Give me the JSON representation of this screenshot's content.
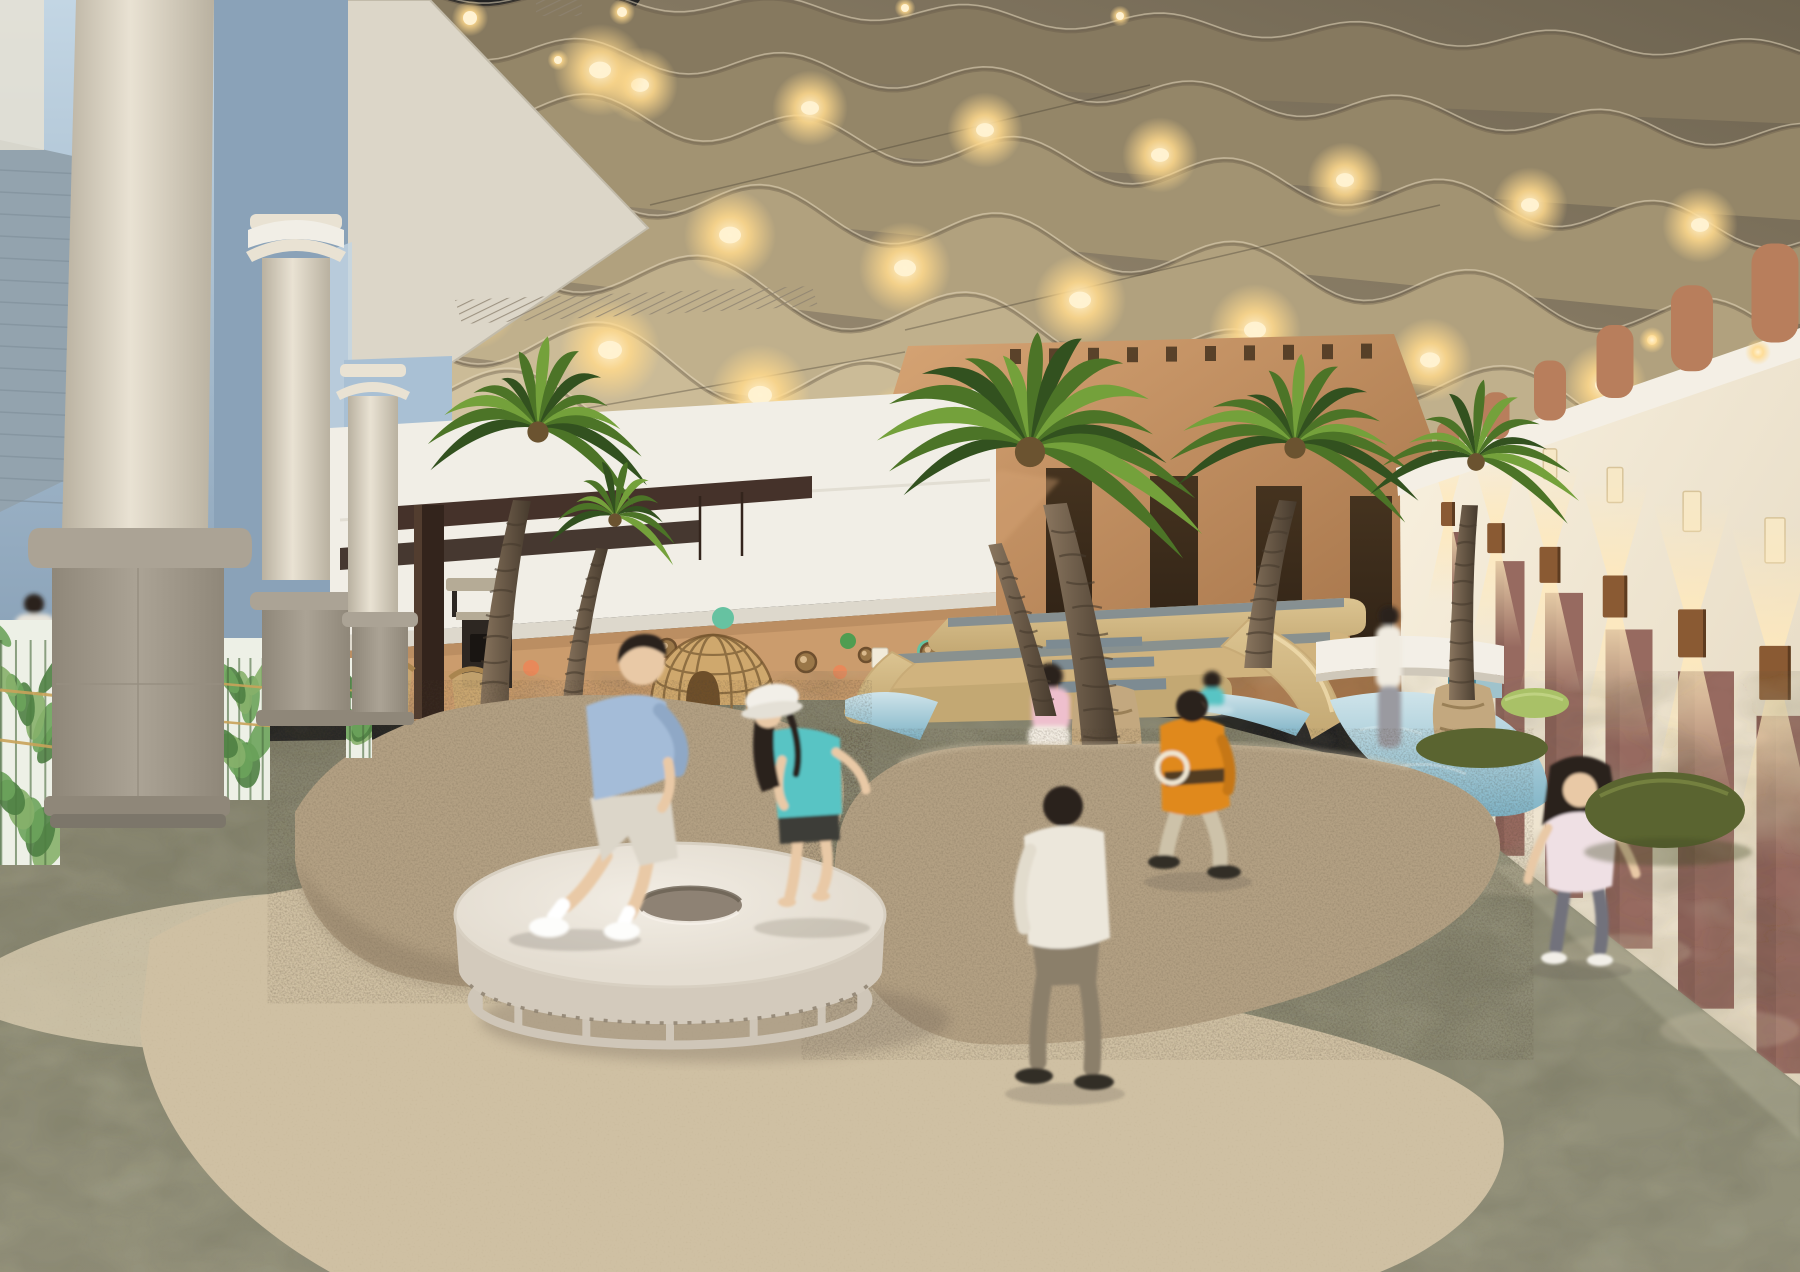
{
  "meta": {
    "kind": "architectural-rendering",
    "description": "Photorealistic rendering of an indoor children's beach-themed playground: wavy acoustic ceiling with warm downlights, classical colonnade with glass plant-mural balustrade on the left, indoor palm trees, carpeted sand dunes, a round white trampoline with a hole, a rattan dome hut, a tiered wooden play structure with slides into a shallow pool, an adobe-style tan building, and a lantern-lit corridor of mauve doors on the right. Children play throughout."
  },
  "palette": {
    "ceilingDark": "#6d6350",
    "ceilingMid": "#a4957a",
    "wave1": "#86795f",
    "wave2": "#948668",
    "wave3": "#a29372",
    "wave4": "#b1a17e",
    "wave5": "#c0b08c",
    "wave6": "#cbbb97",
    "wave7": "#d2c3a1",
    "waveEdge": "#665a48",
    "waveHi": "#e5d9bd",
    "soffit": "#dcd6c8",
    "soffitShade": "#c2bbaa",
    "grille": "#8d8270",
    "glow": "#ffd98c",
    "glowCore": "#fff2d2",
    "coneLight": "#ffe9bc",
    "glassLight": "#c3d6e4",
    "glass": "#a9c0d4",
    "glassDeep": "#8aa2b8",
    "brick": "#93a3ae",
    "whiteWall": "#f1eee6",
    "whiteWallShade": "#ddd8cc",
    "tanWall": "#cb9c6d",
    "tanShade": "#b1855c",
    "adobeLit": "#d6a474",
    "adobe": "#c08a5c",
    "adobeShade": "#a06f45",
    "doorDark": "#45331f",
    "doorDark2": "#2e2115",
    "rightWall": "#f3ebd9",
    "rightWallLit": "#f9f1df",
    "rightWallShade": "#e2d6bf",
    "fascia": "#f4efe5",
    "mauve": "#976a60",
    "mauveDark": "#7d564e",
    "sconce": "#8a5a33",
    "stub": "#b87e5c",
    "nicheGlow": "#f7e8c6",
    "pergola": "#45322a",
    "pergolaDeep": "#33241c",
    "kioskDark": "#2d2722",
    "stone": "#b5ab96",
    "wicker": "#c8a671",
    "woodTable": "#b98a5a",
    "domeFill": "#cfa86d",
    "domeLine": "#8f6f42",
    "domeDark": "#6e4f2a",
    "wood": "#dcc491",
    "woodMid": "#d0b37e",
    "woodShade": "#c3a873",
    "tread": "#7d8b92",
    "pool": "#7fb3c6",
    "poolLight": "#cfe4ea",
    "aqua": "#4f8fa0",
    "aquaLight": "#9fc3cc",
    "mound": "#b3a083",
    "moundDark": "#4a3d2e",
    "floorA": "#84826d",
    "floorB": "#94927b",
    "floorDark": "#55543f",
    "floorLight": "#b9b79e",
    "sand": "#cfc0a3",
    "sandLight": "#d9ccb0",
    "sandGrain": "#8a7a5e",
    "tramp": "#e4ddd1",
    "trampTop": "#f2ede4",
    "trampShade": "#d3cabc",
    "trampBase": "#cfc6b8",
    "trampHole": "#8e8274",
    "poufGreen": "#a9c167",
    "poufOlive": "#5a6430",
    "trunk": "#6b5948",
    "trunkDark": "#463a2d",
    "trunkLight": "#8a765f",
    "burlap": "#c3a87f",
    "frondDark": "#32511f",
    "frond": "#4c7427",
    "frondLight": "#74a13b",
    "tuft": "#6b5330",
    "columnLight": "#e9e2d3",
    "columnShade": "#b9b1a0",
    "pedestal": "#aba395",
    "pedestalDark": "#8f8779",
    "muralBg": "#edf0e6",
    "leafA": "#6ca35b",
    "leafB": "#4e8042",
    "leafC": "#86b06a",
    "rail": "#c9a35a",
    "skin": "#e9c9a6",
    "hair": "#29221b",
    "blueShirt": "#a4bcd8",
    "blueShirtDark": "#8fa8c6",
    "whiteCloth": "#ece7db",
    "teal": "#58c4c4",
    "darkShorts": "#3c3c38",
    "khaki": "#cdc2a9",
    "orange": "#e0891c",
    "pantsGray": "#72727c",
    "pinkTop": "#efe0e4",
    "pinkSit": "#eebfcd",
    "pantsBrown": "#8b7f6b",
    "shoeDark": "#332d26",
    "white": "#f6f3ec"
  },
  "scene": {
    "ceiling": {
      "style": "undulating wavy acoustic ribbons",
      "lights": "warm recessed downlights at wave crests",
      "cables": 3
    },
    "left_colonnade": {
      "columns": 3,
      "pedestals": 3,
      "balustrade": "glass panels printed with tropical plants and two gold rails",
      "exterior": "blue-grey glazing and brick wall"
    },
    "cafe": {
      "pergola": "dark wood beam and post",
      "kiosk": "dark counter with black coffee machine",
      "chairs": "rattan armchairs",
      "seated_people": 2
    },
    "back_wall": {
      "upper": "white",
      "lower": "tan cork with round pegs",
      "dots_colors": [
        "mint",
        "green",
        "orange"
      ],
      "dome": "rattan lattice dome hut with arched opening"
    },
    "adobe_building": {
      "color": "terracotta tan",
      "parapet_slits": 10,
      "dark_doorways": 4
    },
    "play_structure": {
      "material": "bent plywood",
      "treads": "blue-grey",
      "slides": 2,
      "pool": "shallow light-blue water",
      "water_cubes": 2
    },
    "right_corridor": {
      "wall": "cream",
      "door_panels": 6,
      "sconces": "bronze cylinders with up/down light",
      "niches": "small lit wall niches",
      "beam_stubs": "terracotta cylinders above white fascia",
      "poufs": 3
    },
    "sand_area": {
      "mounds": 2,
      "texture": "speckled carpet dune",
      "trampoline": "round white membrane with central hole on ring base"
    },
    "palms": {
      "count": 5,
      "bases": "burlap/rope wrapped"
    },
    "children": [
      {
        "name": "boy-jumping",
        "outfit": "light blue shirt, white shorts, white socks"
      },
      {
        "name": "girl-trampoline",
        "outfit": "white bucket hat, teal top, dark shorts, barefoot"
      },
      {
        "name": "boy-walking-back",
        "outfit": "cream long-sleeve, brown trousers"
      },
      {
        "name": "boy-orange",
        "outfit": "orange jacket with ring pack, khaki trousers"
      },
      {
        "name": "girl-running",
        "outfit": "pink-white top, grey trousers"
      },
      {
        "name": "girl-sitting-platform",
        "outfit": "pink top, white skirt"
      },
      {
        "name": "child-in-water",
        "outfit": "teal"
      },
      {
        "name": "woman-at-counter",
        "outfit": "white top"
      }
    ]
  }
}
